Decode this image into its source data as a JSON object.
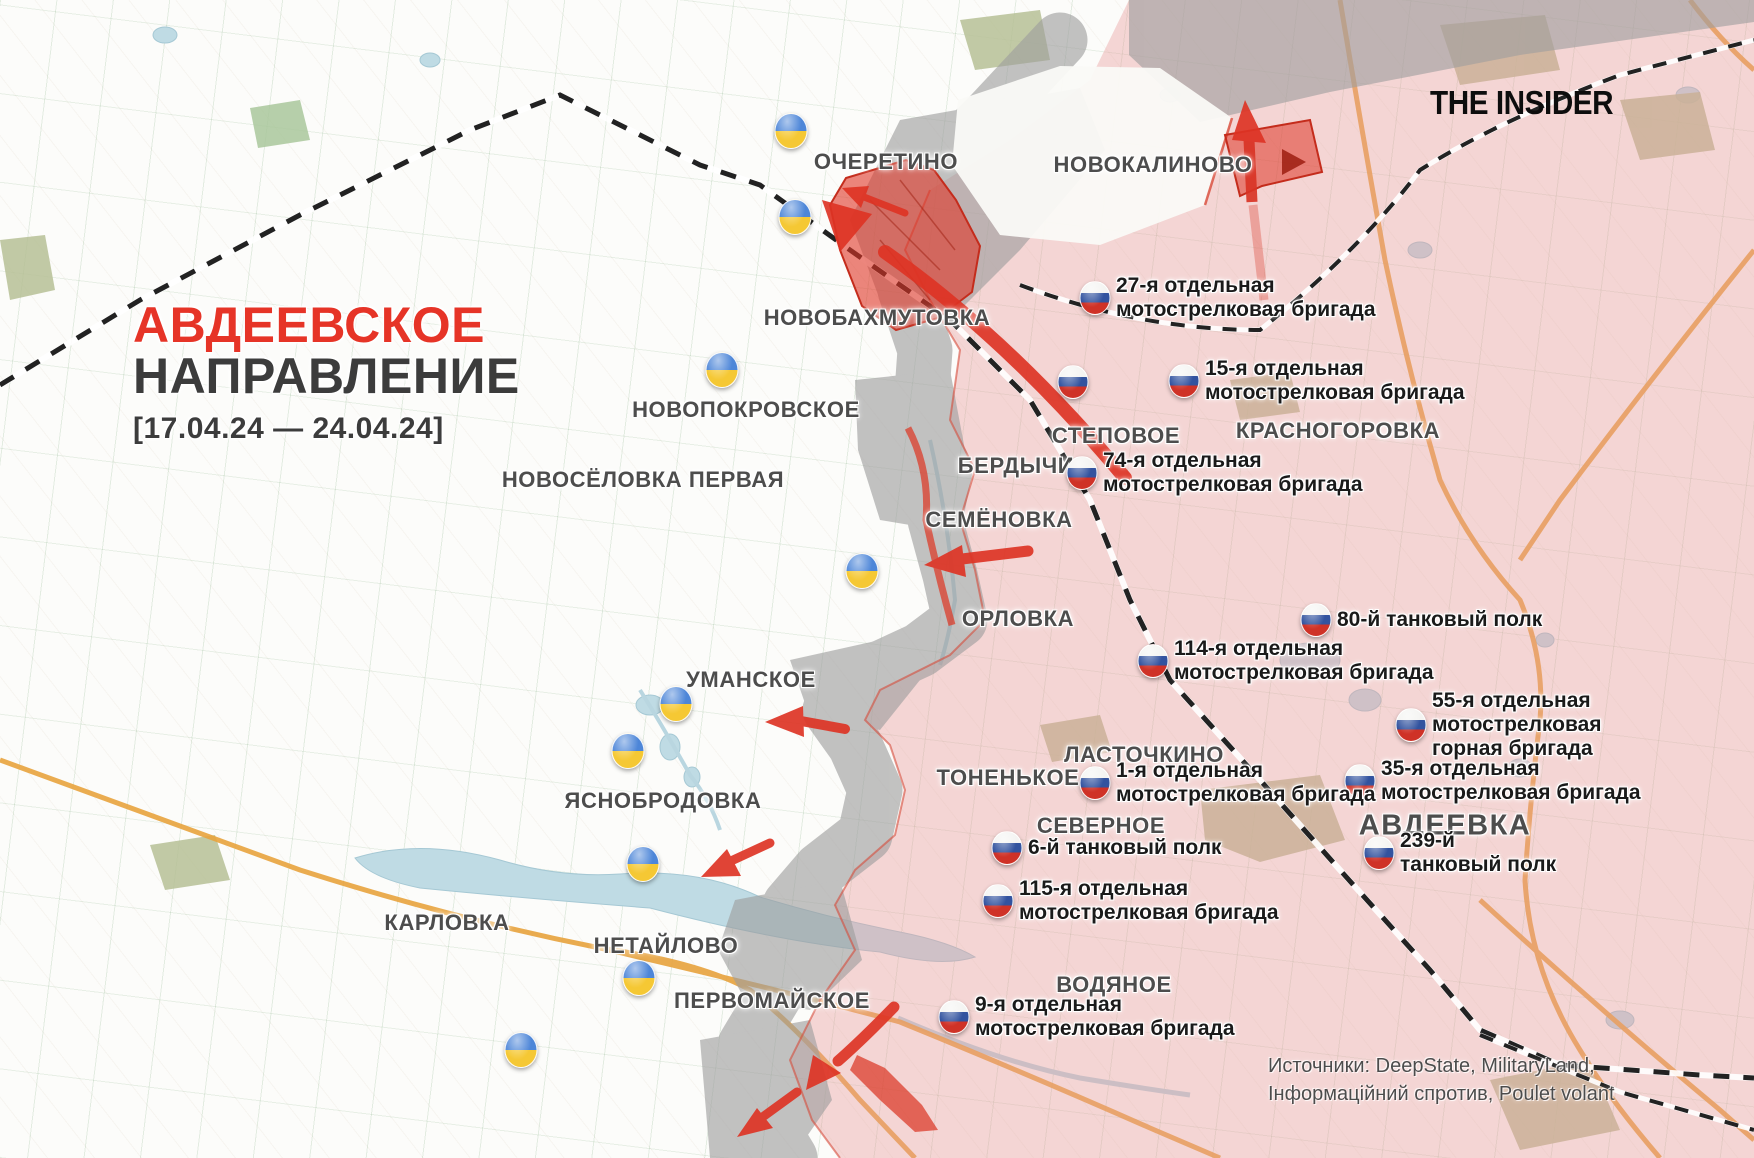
{
  "header": {
    "title_line1": "АВДЕЕВСКОЕ",
    "title_line2": "НАПРАВЛЕНИЕ",
    "date_range": "[17.04.24 — 24.04.24]",
    "logo": "THE INSIDER"
  },
  "footer": {
    "sources_line1": "Источники: DeepState, MilitaryLand,",
    "sources_line2": "Інформаційний спротив, Poulet volant"
  },
  "colors": {
    "title_red": "#e63427",
    "title_dark": "#3c3c3c",
    "town_label": "#4d4d4d",
    "unit_label": "#1a1a1a",
    "occupied_pink": "#e89b9b",
    "contested_gray": "#9e9e9e",
    "assault_red": "#de3425",
    "ua_flag_blue": "#4d86d8",
    "ua_flag_yellow": "#f5c834",
    "ru_flag_white": "#f4f4f2",
    "ru_flag_blue": "#32539f",
    "ru_flag_red": "#cf3227",
    "road_orange": "#e8a33d",
    "railway_black": "#222222",
    "water_blue": "#bfdbe4"
  },
  "map": {
    "towns": [
      {
        "name": "ОЧЕРЕТИНО",
        "x": 886,
        "y": 162
      },
      {
        "name": "НОВОКАЛИНОВО",
        "x": 1153,
        "y": 165
      },
      {
        "name": "НОВОБАХМУТОВКА",
        "x": 877,
        "y": 318
      },
      {
        "name": "НОВОПОКРОВСКОЕ",
        "x": 746,
        "y": 410
      },
      {
        "name": "НОВОСЁЛОВКА ПЕРВАЯ",
        "x": 643,
        "y": 480
      },
      {
        "name": "КРАСНОГОРОВКА",
        "x": 1338,
        "y": 431
      },
      {
        "name": "СТЕПОВОЕ",
        "x": 1116,
        "y": 436
      },
      {
        "name": "БЕРДЫЧИ",
        "x": 1016,
        "y": 466
      },
      {
        "name": "СЕМЁНОВКА",
        "x": 999,
        "y": 520
      },
      {
        "name": "ОРЛОВКА",
        "x": 1018,
        "y": 619
      },
      {
        "name": "УМАНСКОЕ",
        "x": 751,
        "y": 680
      },
      {
        "name": "ЛАСТОЧКИНО",
        "x": 1144,
        "y": 755
      },
      {
        "name": "ТОНЕНЬКОЕ",
        "x": 1008,
        "y": 778
      },
      {
        "name": "ЯСНОБРОДОВКА",
        "x": 663,
        "y": 801
      },
      {
        "name": "СЕВЕРНОЕ",
        "x": 1101,
        "y": 826
      },
      {
        "name": "АВДЕЕВКА",
        "x": 1445,
        "y": 826,
        "large": true
      },
      {
        "name": "КАРЛОВКА",
        "x": 447,
        "y": 923
      },
      {
        "name": "НЕТАЙЛОВО",
        "x": 666,
        "y": 946
      },
      {
        "name": "ПЕРВОМАЙСКОЕ",
        "x": 772,
        "y": 1001
      },
      {
        "name": "ВОДЯНОЕ",
        "x": 1114,
        "y": 985
      }
    ],
    "units": [
      {
        "id": "ua-115",
        "country": "ua",
        "x": 791,
        "y": 131,
        "side": "left",
        "lines": [
          "115-я отдельная",
          "механизированная бригада"
        ]
      },
      {
        "id": "ua-47",
        "country": "ua",
        "x": 795,
        "y": 217,
        "side": "left",
        "lines": [
          "47-я отдельная",
          "механизированная бригада"
        ]
      },
      {
        "id": "ua-23",
        "country": "ua",
        "x": 722,
        "y": 370,
        "side": "left",
        "lines": [
          "23-я отдельная",
          "механизированная",
          "бригада"
        ]
      },
      {
        "id": "ua-3",
        "country": "ua",
        "x": 862,
        "y": 571,
        "side": "left",
        "lines": [
          "3-я отдельная",
          "штурмовая бригада"
        ]
      },
      {
        "id": "ua-68",
        "country": "ua",
        "x": 676,
        "y": 704,
        "side": "left",
        "lines": [
          "68-я отдельная егерская бригада"
        ]
      },
      {
        "id": "ua-71",
        "country": "ua",
        "x": 628,
        "y": 751,
        "side": "left",
        "lines": [
          "71-я отдельная егерская бригада"
        ]
      },
      {
        "id": "ua-53",
        "country": "ua",
        "x": 643,
        "y": 864,
        "side": "left",
        "lines": [
          "53-я отдельная",
          "механизированная бригада"
        ]
      },
      {
        "id": "ua-59",
        "country": "ua",
        "x": 639,
        "y": 978,
        "side": "left",
        "lines": [
          "59-я отдельная",
          "мотопехотная бригада"
        ]
      },
      {
        "id": "ua-56",
        "country": "ua",
        "x": 521,
        "y": 1050,
        "side": "left",
        "lines": [
          "56-я отдельная",
          "мотопехотная бригада"
        ]
      },
      {
        "id": "ru-27",
        "country": "ru",
        "x": 1095,
        "y": 298,
        "side": "right",
        "lines": [
          "27-я отдельная",
          "мотострелковая бригада"
        ]
      },
      {
        "id": "ru-30",
        "country": "ru",
        "x": 1073,
        "y": 382,
        "side": "left",
        "lines": [
          "30-я отдельная",
          "мотострелковая бригада"
        ]
      },
      {
        "id": "ru-15",
        "country": "ru",
        "x": 1184,
        "y": 381,
        "side": "right",
        "lines": [
          "15-я отдельная",
          "мотострелковая бригада"
        ]
      },
      {
        "id": "ru-74",
        "country": "ru",
        "x": 1082,
        "y": 473,
        "side": "right",
        "lines": [
          "74-я отдельная",
          "мотострелковая бригада"
        ]
      },
      {
        "id": "ru-80",
        "country": "ru",
        "x": 1316,
        "y": 620,
        "side": "right",
        "lines": [
          "80-й танковый полк"
        ]
      },
      {
        "id": "ru-114",
        "country": "ru",
        "x": 1153,
        "y": 661,
        "side": "right",
        "lines": [
          "114-я отдельная",
          "мотострелковая бригада"
        ]
      },
      {
        "id": "ru-55",
        "country": "ru",
        "x": 1411,
        "y": 725,
        "side": "right",
        "lines": [
          "55-я отдельная",
          "мотострелковая",
          "горная бригада"
        ]
      },
      {
        "id": "ru-35",
        "country": "ru",
        "x": 1360,
        "y": 781,
        "side": "right",
        "lines": [
          "35-я отдельная",
          "мотострелковая бригада"
        ]
      },
      {
        "id": "ru-1",
        "country": "ru",
        "x": 1095,
        "y": 783,
        "side": "right",
        "lines": [
          "1-я отдельная",
          "мотострелковая бригада"
        ]
      },
      {
        "id": "ru-6",
        "country": "ru",
        "x": 1007,
        "y": 848,
        "side": "right",
        "lines": [
          "6-й танковый полк"
        ]
      },
      {
        "id": "ru-115",
        "country": "ru",
        "x": 998,
        "y": 901,
        "side": "right",
        "lines": [
          "115-я отдельная",
          "мотострелковая бригада"
        ]
      },
      {
        "id": "ru-239",
        "country": "ru",
        "x": 1379,
        "y": 853,
        "side": "right",
        "lines": [
          "239-й",
          "танковый полк"
        ]
      },
      {
        "id": "ru-9",
        "country": "ru",
        "x": 954,
        "y": 1017,
        "side": "right",
        "lines": [
          "9-я отдельная",
          "мотострелковая бригада"
        ]
      }
    ]
  }
}
